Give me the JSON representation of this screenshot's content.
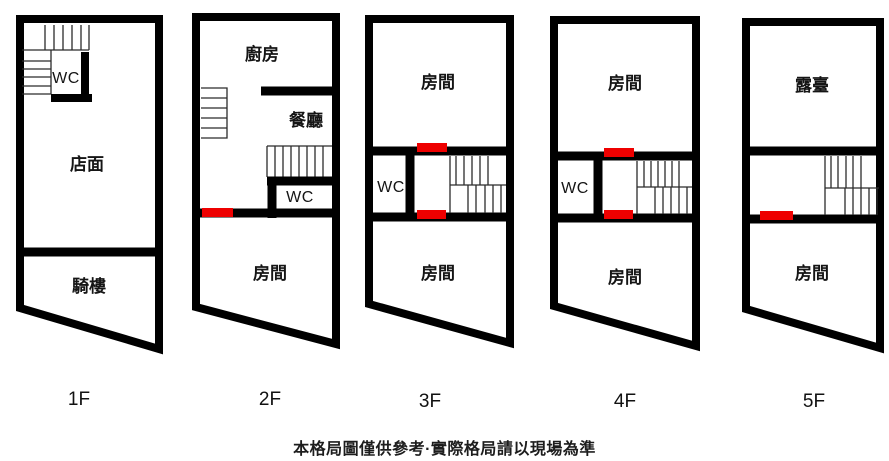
{
  "caption": "本格局圖僅供參考·實際格局請以現場為準",
  "colors": {
    "wall": "#000000",
    "door_marker": "#ee0000",
    "text": "#151515",
    "background": "#ffffff"
  },
  "floors": [
    {
      "label": "1F",
      "rooms": {
        "wc": "WC",
        "storefront": "店面",
        "arcade": "騎樓"
      }
    },
    {
      "label": "2F",
      "rooms": {
        "kitchen": "廚房",
        "dining": "餐廳",
        "wc": "WC",
        "bedroom": "房間"
      }
    },
    {
      "label": "3F",
      "rooms": {
        "room_top": "房間",
        "wc": "WC",
        "room_bottom": "房間"
      }
    },
    {
      "label": "4F",
      "rooms": {
        "room_top": "房間",
        "wc": "WC",
        "room_bottom": "房間"
      }
    },
    {
      "label": "5F",
      "rooms": {
        "terrace": "露臺",
        "bedroom": "房間"
      }
    }
  ]
}
